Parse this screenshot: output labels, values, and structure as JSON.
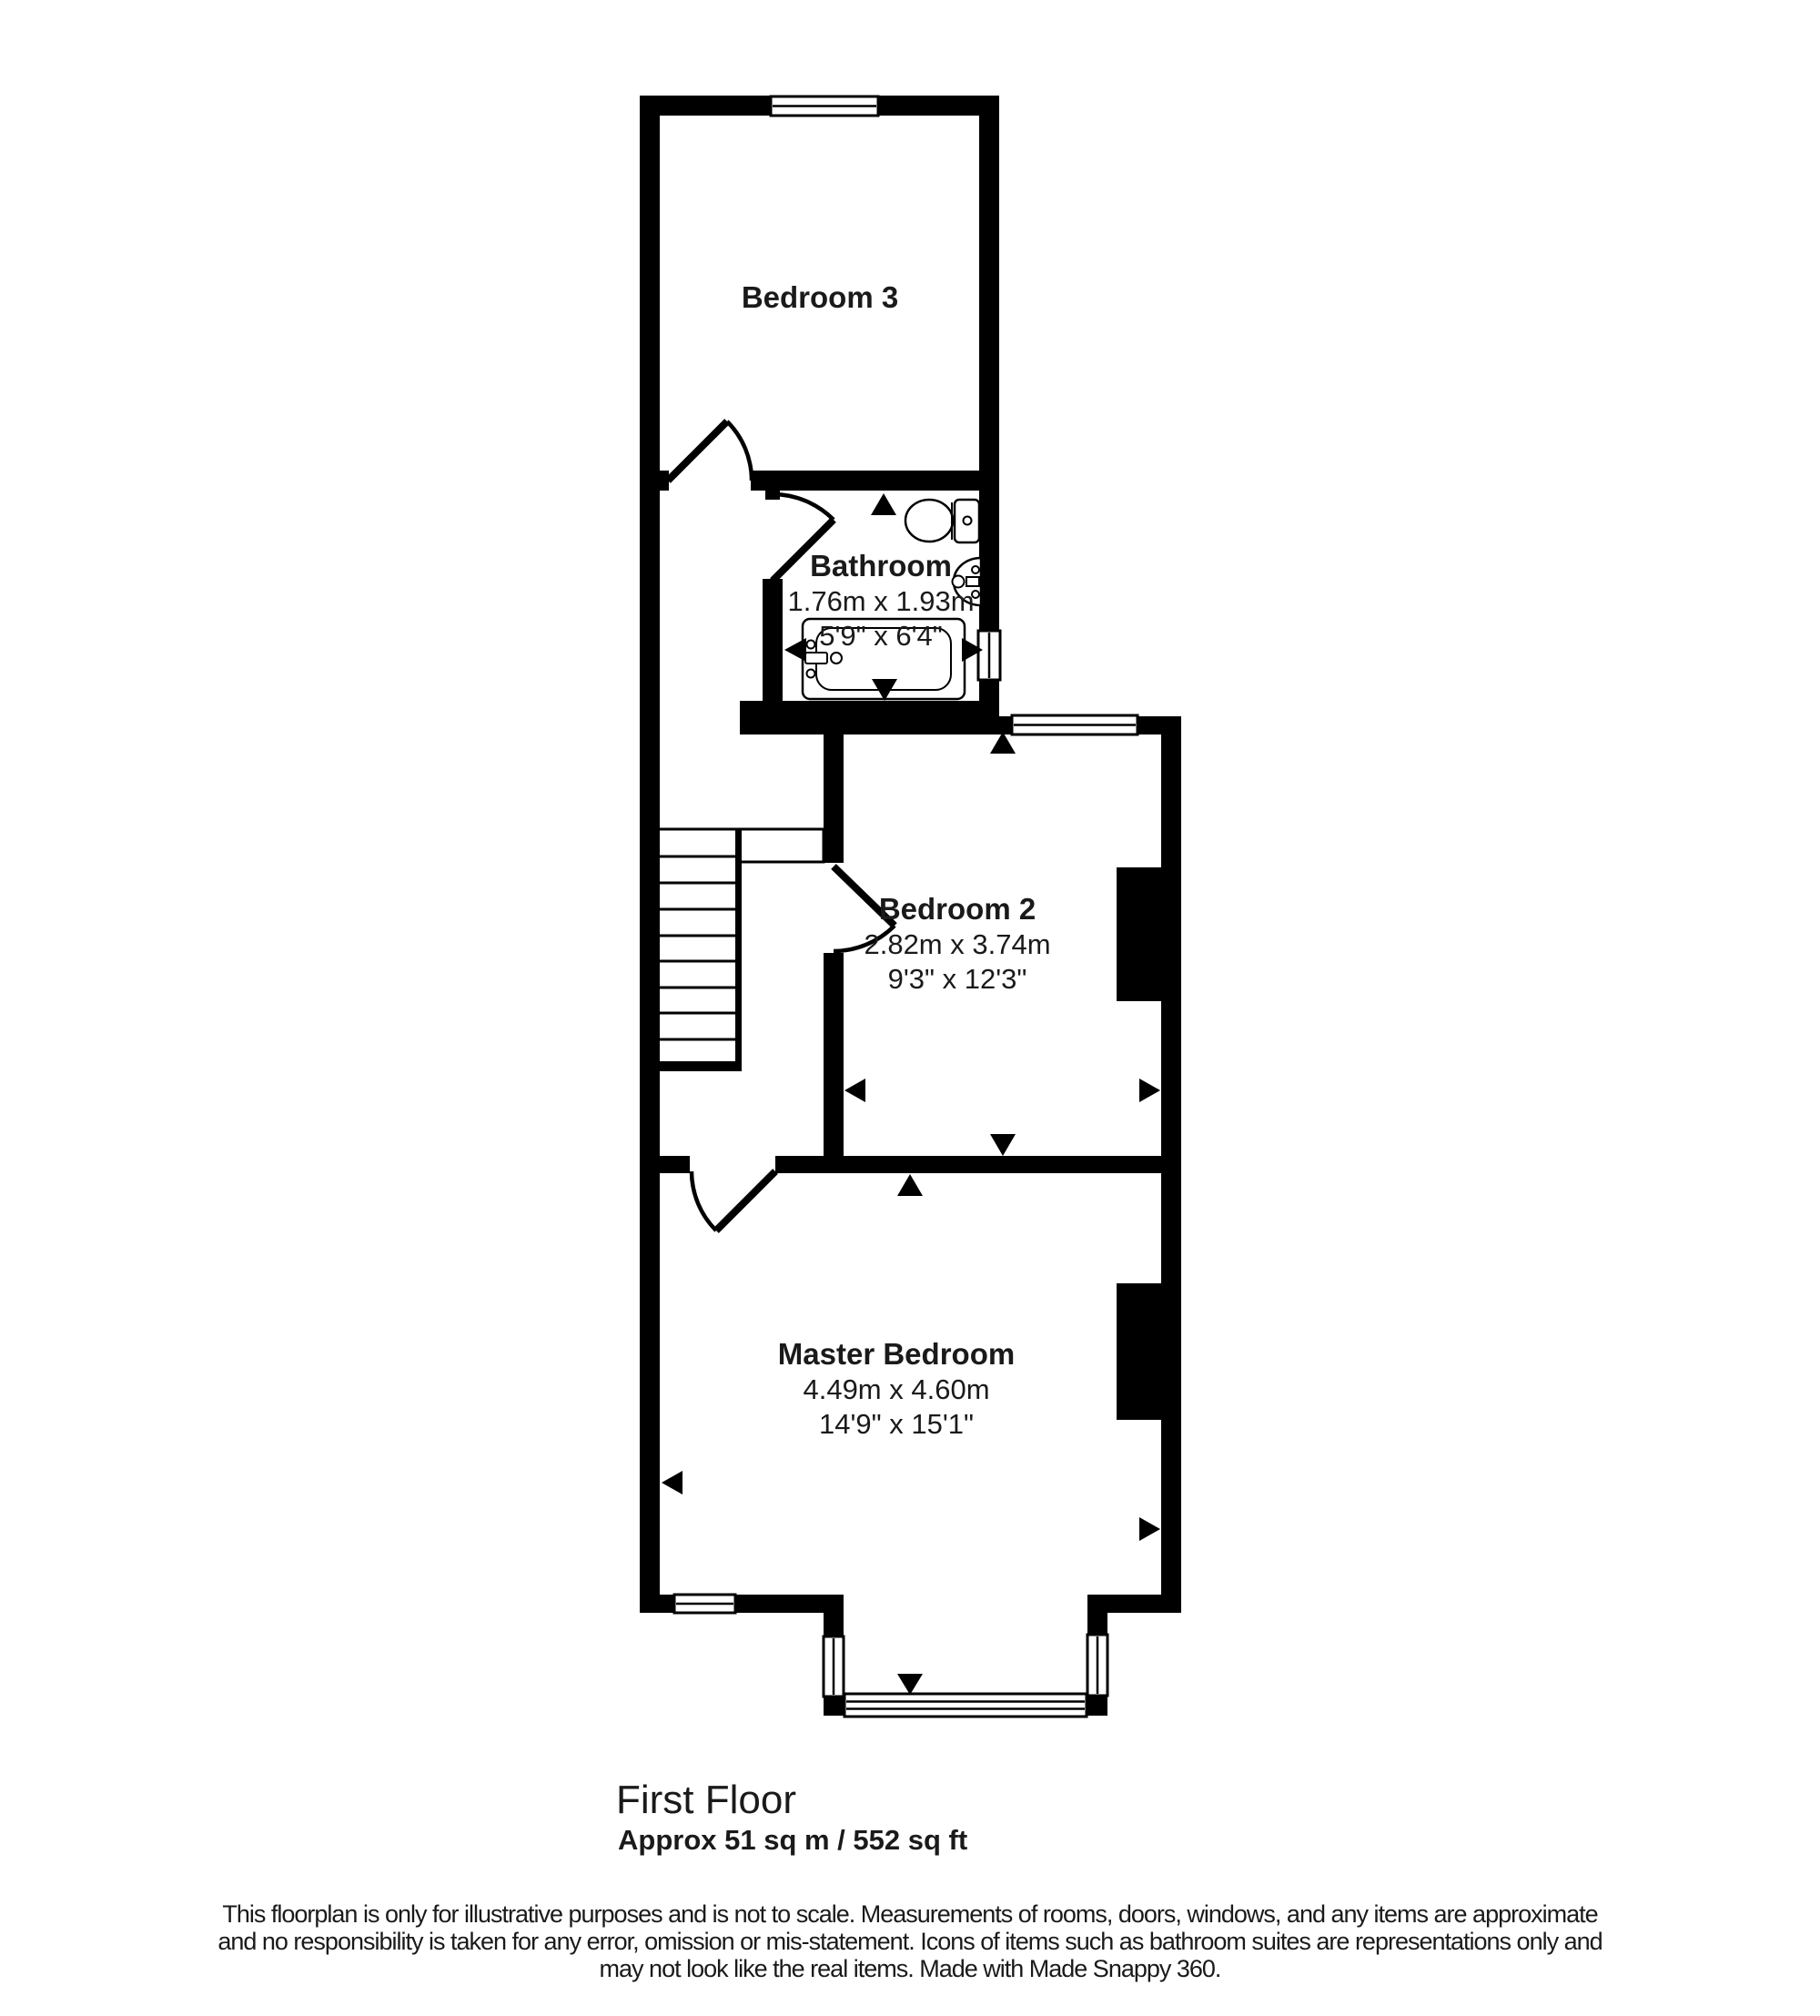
{
  "floorplan": {
    "rooms": {
      "bedroom3": {
        "name": "Bedroom 3"
      },
      "bathroom": {
        "name": "Bathroom",
        "metric": "1.76m x 1.93m",
        "imperial": "5'9\" x 6'4\""
      },
      "bedroom2": {
        "name": "Bedroom 2",
        "metric": "2.82m x 3.74m",
        "imperial": "9'3\" x 12'3\""
      },
      "master": {
        "name": "Master Bedroom",
        "metric": "4.49m x 4.60m",
        "imperial": "14'9\" x 15'1\""
      }
    },
    "floor_label": "First Floor",
    "area_label": "Approx 51 sq m / 552 sq ft",
    "disclaimer": {
      "line1": "This floorplan is only for illustrative purposes and is not to scale. Measurements of rooms, doors, windows, and any items are approximate",
      "line2": "and no responsibility is taken for any error, omission or mis-statement. Icons of items such as bathroom suites are representations only and",
      "line3": "may not look like the real items. Made with Made Snappy 360."
    },
    "colors": {
      "wall": "#000000",
      "background": "#ffffff",
      "text": "#1a1a1a"
    }
  }
}
